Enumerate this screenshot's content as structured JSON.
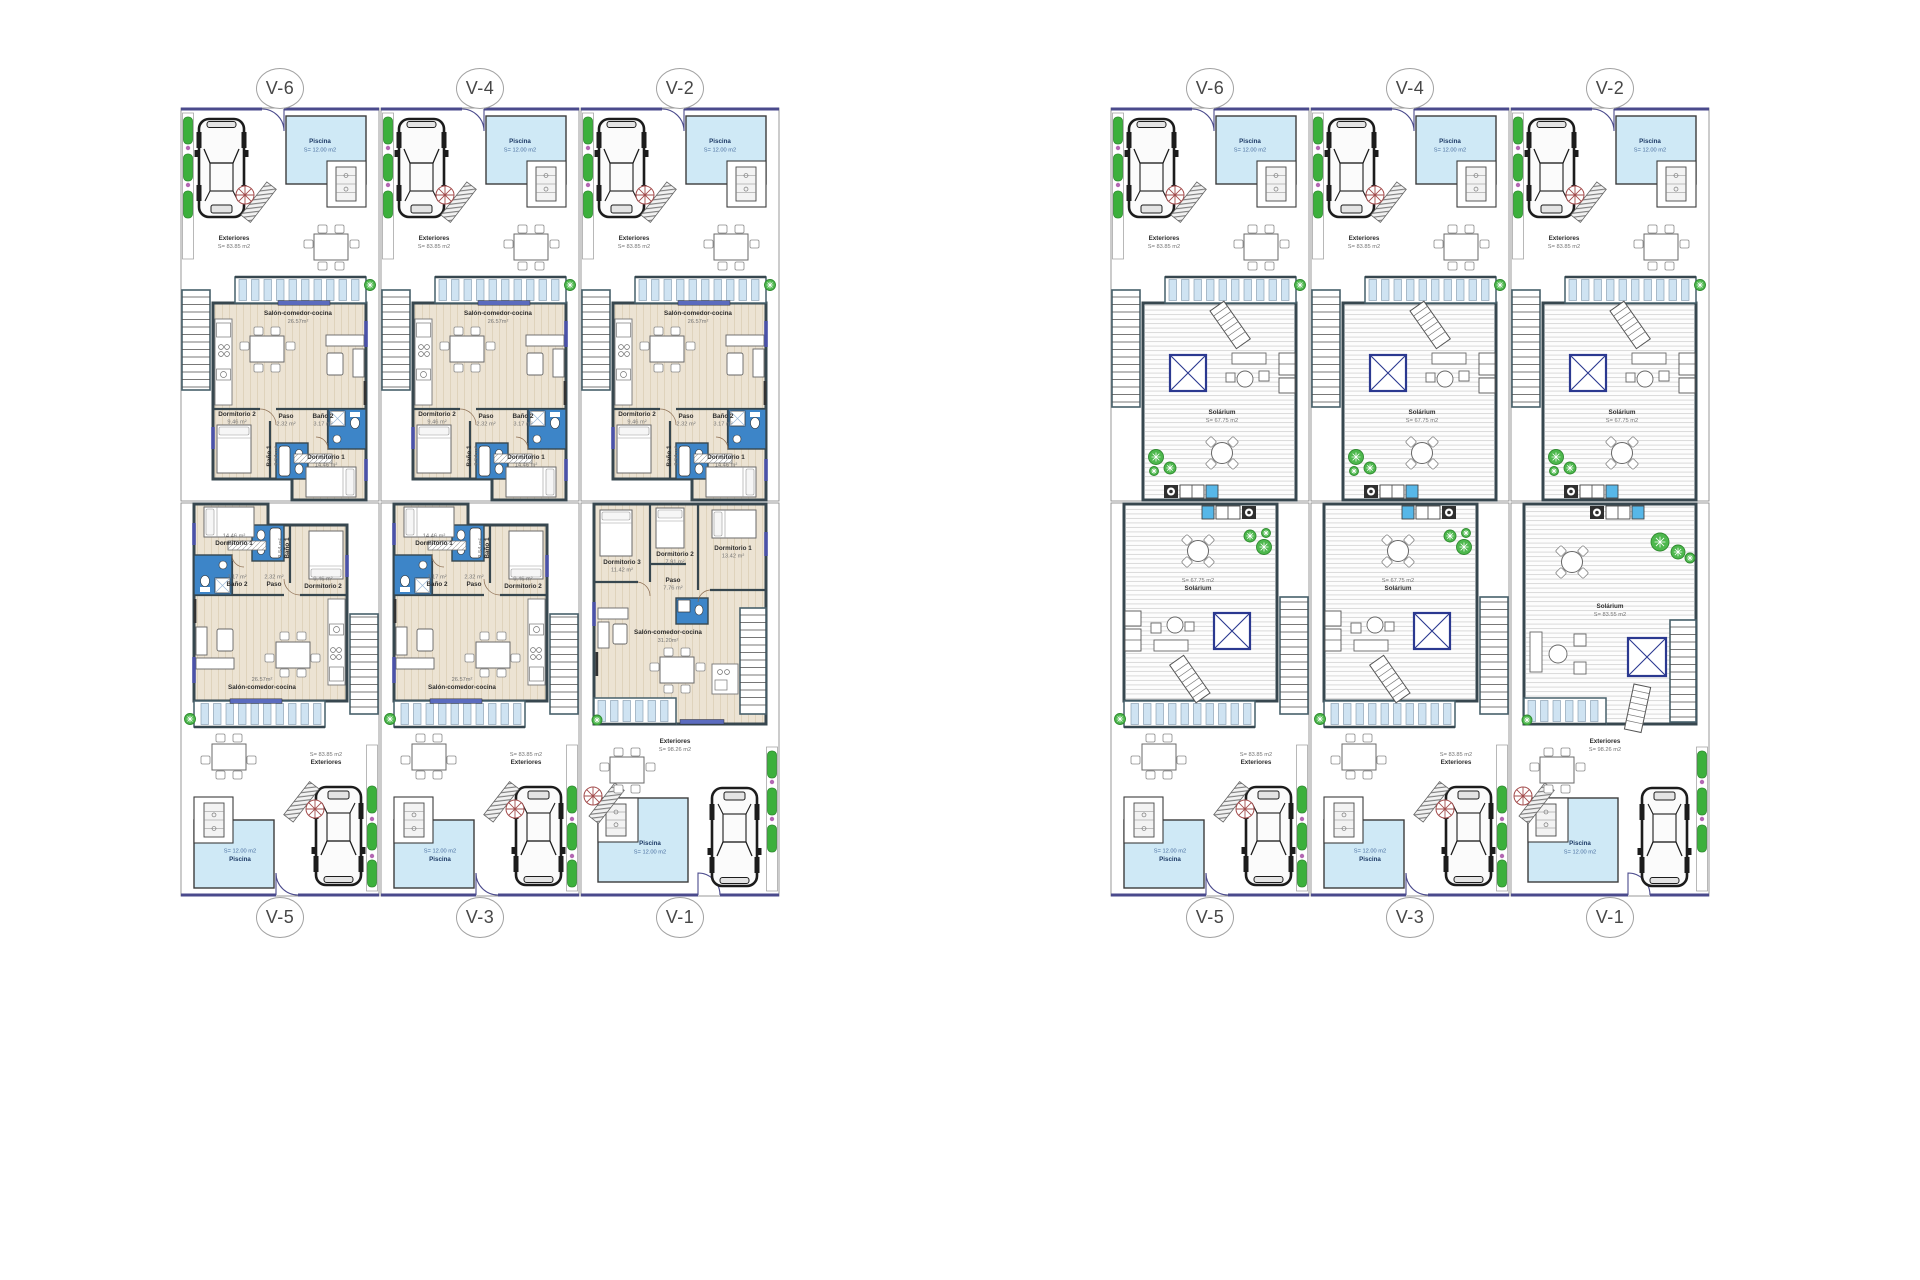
{
  "sheet": {
    "description": "Villa floor plans: ground floor (left) and solarium roof level (right)",
    "background": "#ffffff"
  },
  "blocks": [
    {
      "id": "ground",
      "name": "ground-floor-plans",
      "top_labels": [
        "V-6",
        "V-4",
        "V-2"
      ],
      "bottom_labels": [
        "V-5",
        "V-3",
        "V-1"
      ]
    },
    {
      "id": "roof",
      "name": "solarium-roof-plans",
      "top_labels": [
        "V-6",
        "V-4",
        "V-2"
      ],
      "bottom_labels": [
        "V-5",
        "V-3",
        "V-1"
      ]
    }
  ],
  "room_texts": {
    "ground_standard": {
      "piscina": {
        "label": "Piscina",
        "area": "S= 12.00 m2"
      },
      "exteriores": {
        "label": "Exteriores",
        "area": "S= 83.85 m2"
      },
      "salon": {
        "label": "Salón-comedor-cocina",
        "area": "26.57m²"
      },
      "paso": {
        "label": "Paso",
        "area": "2.32 m²"
      },
      "bano2": {
        "label": "Baño 2",
        "area": "3.17 m²"
      },
      "dorm2": {
        "label": "Dormitorio 2",
        "area": "9.46 m²"
      },
      "bano1": {
        "label": "Baño 1",
        "area": "3.54 m²"
      },
      "dorm1": {
        "label": "Dormitorio 1",
        "area": "14.46 m²"
      }
    },
    "ground_v1": {
      "piscina": {
        "label": "Piscina",
        "area": "S= 12.00 m2"
      },
      "exteriores": {
        "label": "Exteriores",
        "area": "S= 98.26 m2"
      },
      "salon": {
        "label": "Salón-comedor-cocina",
        "area": "31.20m²"
      },
      "paso": {
        "label": "Paso",
        "area": "7.76 m²"
      },
      "dorm1": {
        "label": "Dormitorio 1",
        "area": "13.42 m²"
      },
      "dorm2": {
        "label": "Dormitorio 2",
        "area": "7.91 m²"
      },
      "dorm3": {
        "label": "Dormitorio 3",
        "area": "11.42 m²"
      }
    },
    "roof_standard": {
      "piscina": {
        "label": "Piscina",
        "area": "S= 12.00 m2"
      },
      "exteriores": {
        "label": "Exteriores",
        "area": "S= 83.85 m2"
      },
      "solarium": {
        "label": "Solárium",
        "area": "S= 67.75 m2"
      }
    },
    "roof_v1": {
      "piscina": {
        "label": "Piscina",
        "area": "S= 12.00 m2"
      },
      "exteriores": {
        "label": "Exteriores",
        "area": "S= 98.26 m2"
      },
      "solarium": {
        "label": "Solárium",
        "area": "S= 83.55 m2"
      }
    }
  },
  "colors": {
    "pool_fill": "#cfe9f6",
    "bath_fill": "#3d85c8",
    "floor_fill": "#ece3d3",
    "wall": "#37474f",
    "street_wall": "#4a4a8c",
    "accent_blue": "#4a52a8",
    "hedge_green": "#3cb03c",
    "plant_green": "#4db84d",
    "slat_fill": "#cfe3f2"
  }
}
